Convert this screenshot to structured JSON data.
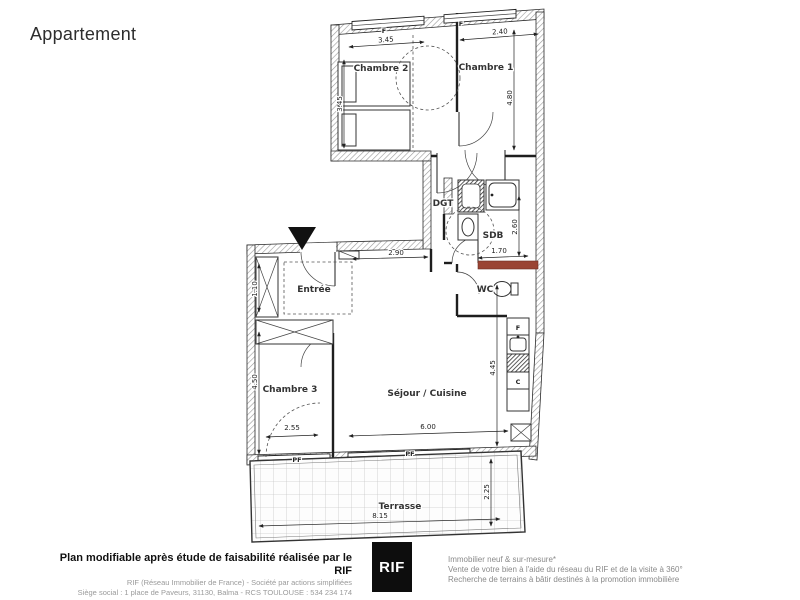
{
  "title": "Appartement",
  "plan": {
    "rooms": {
      "chambre1": "Chambre 1",
      "chambre2": "Chambre 2",
      "chambre3": "Chambre 3",
      "sejour": "Séjour / Cuisine",
      "entree": "Entrée",
      "dgt": "DGT",
      "sdb": "SDB",
      "wc": "WC",
      "terrasse": "Terrasse"
    },
    "dims": {
      "chambre2_width": "3.45",
      "chambre1_width": "2.40",
      "chambre2_height": "3.45",
      "chambre1_height": "4.80",
      "hall_width": "2.90",
      "sdb_height": "2.60",
      "sdb_width": "1.70",
      "entree_closet": "1.10",
      "chambre3_height": "4.50",
      "chambre3_door": "2.55",
      "sejour_width": "6.00",
      "sejour_height": "4.45",
      "terrasse_width": "8.15",
      "terrasse_depth": "2.25"
    },
    "tags": {
      "window1": "F",
      "window2": "F",
      "fridge": "F",
      "cabinet": "C",
      "pf_left": "PF",
      "pf_right": "PF"
    },
    "colors": {
      "accent_red": "#9a4433",
      "wall_hatch": "#999999",
      "line": "#222222"
    }
  },
  "footer": {
    "left_bold": "Plan modifiable après étude de faisabilité réalisée par le RIF",
    "left_line2": "RIF (Réseau Immobilier de France) - Société par actions simplifiées",
    "left_line3": "Siège social : 1 place de Paveurs, 31130, Balma - RCS TOULOUSE : 534 234 174",
    "logo": "RIF",
    "right_line1": "Immobilier neuf & sur-mesure*",
    "right_line2": "Vente de votre bien à l'aide du réseau du RIF et de la visite à 360°",
    "right_line3": "Recherche de terrains à bâtir destinés à la promotion immobilière"
  }
}
